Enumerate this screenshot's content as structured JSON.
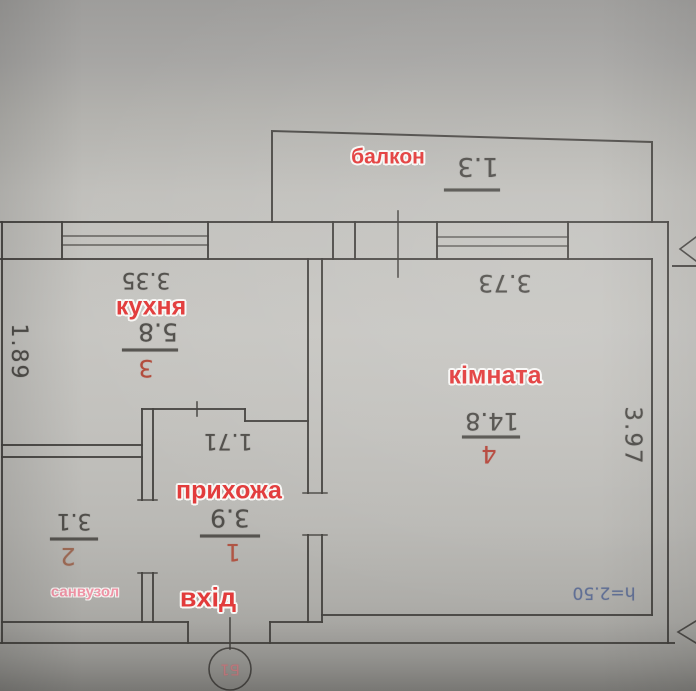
{
  "plan": {
    "balcony": {
      "label": "балкон",
      "width_dim": "1.3"
    },
    "kitchen": {
      "label": "кухня",
      "top_dim": "3.35",
      "area": "5.8",
      "number": "3"
    },
    "room": {
      "label": "кімната",
      "top_dim": "3.73",
      "area": "14.8",
      "number": "4",
      "side_dim": "3.97",
      "height_note": "h=2.50"
    },
    "hallway": {
      "label": "прихожа",
      "top_dim": "1.71",
      "area": "3.9",
      "number": "1"
    },
    "bathroom": {
      "label": "санвузол",
      "area": "3.1",
      "number": "2"
    },
    "entrance": {
      "label": "вхід",
      "door_tag": "Б1"
    },
    "left_dim": "1.89"
  },
  "colors": {
    "red_label": "#e23b3b",
    "pink_label": "#ef93a5",
    "pencil": "#504e4a",
    "blue_note": "#5f6e94",
    "wall_line": "#454340",
    "paper": "#c2c1bd"
  }
}
